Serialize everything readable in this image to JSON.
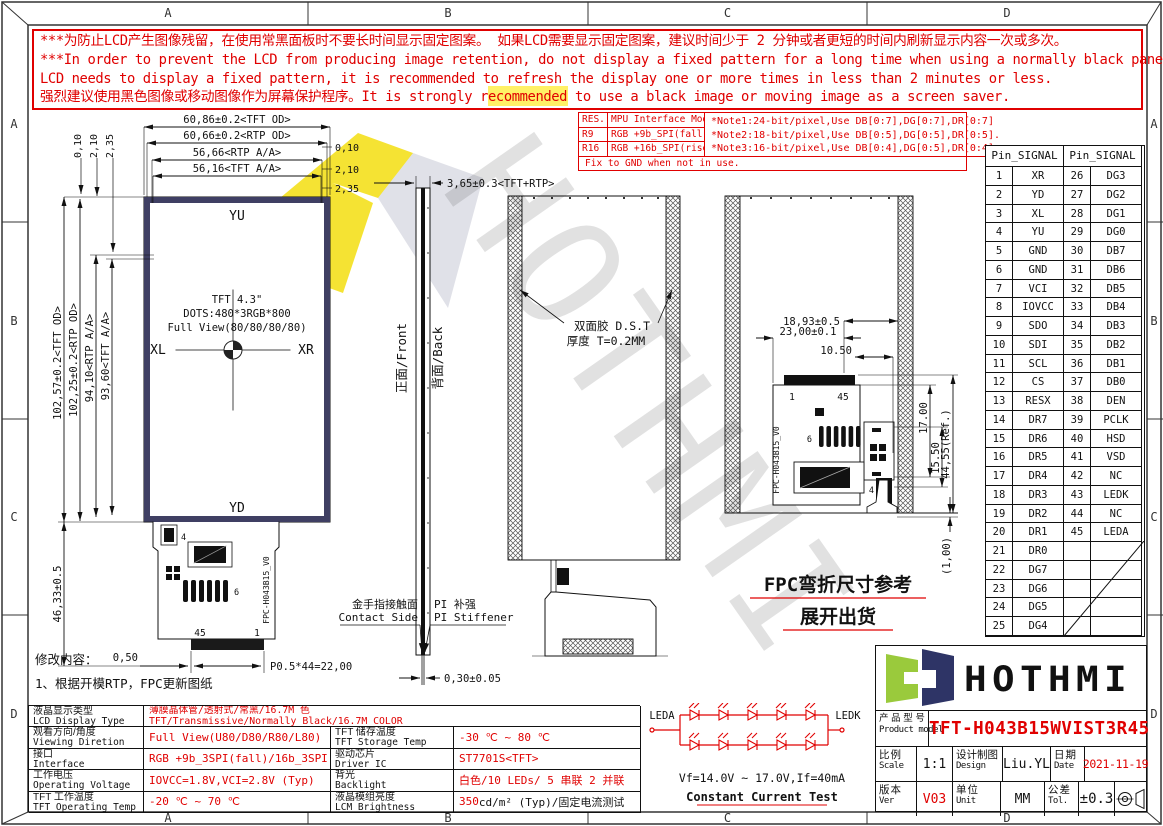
{
  "grid": {
    "cols": [
      "A",
      "B",
      "C",
      "D"
    ],
    "rows": [
      "A",
      "B",
      "C",
      "D"
    ]
  },
  "warning": {
    "lines": [
      "***为防止LCD产生图像残留，在使用常黑面板时不要长时间显示固定图案。 如果LCD需要显示固定图案，建议时间少于 2 分钟或者更短的时间内刷新显示内容一次或多次。",
      "***In order to prevent the LCD from producing image retention, do not display a fixed pattern for a long time when using a normally black panel. If the",
      " LCD needs to display a fixed pattern, it is recommended to refresh the display one or more times in less than 2 minutes or less.",
      "强烈建议使用黑色图像或移动图像作为屏幕保护程序。It is strongly recommended to use a black image or moving image as a screen saver."
    ]
  },
  "mode_table": {
    "rows": [
      [
        "RES.",
        "MPU Interface Mode"
      ],
      [
        "R9",
        "RGB +9b_SPI(fall)"
      ],
      [
        "R16",
        "RGB +16b_SPI(rise)"
      ]
    ],
    "footer": "Fix to GND  when not in use.",
    "notes": [
      "*Note1:24-bit/pixel,Use DB[0:7],DG[0:7],DR[0:7]",
      "*Note2:18-bit/pixel,Use DB[0:5],DG[0:5],DR[0:5].",
      "*Note3:16-bit/pixel,Use DB[0:4],DG[0:5],DR[0:4]."
    ]
  },
  "pin_table": {
    "header_left": "Pin_SIGNAL",
    "header_right": "Pin_SIGNAL",
    "left": [
      [
        "1",
        "XR"
      ],
      [
        "2",
        "YD"
      ],
      [
        "3",
        "XL"
      ],
      [
        "4",
        "YU"
      ],
      [
        "5",
        "GND"
      ],
      [
        "6",
        "GND"
      ],
      [
        "7",
        "VCI"
      ],
      [
        "8",
        "IOVCC"
      ],
      [
        "9",
        "SDO"
      ],
      [
        "10",
        "SDI"
      ],
      [
        "11",
        "SCL"
      ],
      [
        "12",
        "CS"
      ],
      [
        "13",
        "RESX"
      ],
      [
        "14",
        "DR7"
      ],
      [
        "15",
        "DR6"
      ],
      [
        "16",
        "DR5"
      ],
      [
        "17",
        "DR4"
      ],
      [
        "18",
        "DR3"
      ],
      [
        "19",
        "DR2"
      ],
      [
        "20",
        "DR1"
      ],
      [
        "21",
        "DR0"
      ],
      [
        "22",
        "DG7"
      ],
      [
        "23",
        "DG6"
      ],
      [
        "24",
        "DG5"
      ],
      [
        "25",
        "DG4"
      ]
    ],
    "right": [
      [
        "26",
        "DG3"
      ],
      [
        "27",
        "DG2"
      ],
      [
        "28",
        "DG1"
      ],
      [
        "29",
        "DG0"
      ],
      [
        "30",
        "DB7"
      ],
      [
        "31",
        "DB6"
      ],
      [
        "32",
        "DB5"
      ],
      [
        "33",
        "DB4"
      ],
      [
        "34",
        "DB3"
      ],
      [
        "35",
        "DB2"
      ],
      [
        "36",
        "DB1"
      ],
      [
        "37",
        "DB0"
      ],
      [
        "38",
        "DEN"
      ],
      [
        "39",
        "PCLK"
      ],
      [
        "40",
        "HSD"
      ],
      [
        "41",
        "VSD"
      ],
      [
        "42",
        "NC"
      ],
      [
        "43",
        "LEDK"
      ],
      [
        "44",
        "NC"
      ],
      [
        "45",
        "LEDA"
      ],
      [
        "",
        ""
      ],
      [
        "",
        ""
      ],
      [
        "",
        ""
      ],
      [
        "",
        ""
      ],
      [
        "",
        ""
      ]
    ]
  },
  "drawing": {
    "watermark": "HOTHMI",
    "front": {
      "top_dims": [
        "60,86±0.2<TFT OD>",
        "60,66±0.2<RTP OD>",
        "56,66<RTP A/A>",
        "56,16<TFT A/A>"
      ],
      "offsets": [
        "0,10",
        "2,10",
        "2,35"
      ],
      "left_dims": [
        "102,57±0.2<TFT OD>",
        "102,25±0.2<RTP OD>",
        "94,10<RTP A/A>",
        "93,60<TFT A/A>"
      ],
      "bottom_left_dim": "46,33±0.5",
      "yu": "YU",
      "yd": "YD",
      "xl": "XL",
      "xr": "XR",
      "center": [
        "TFT 4.3\"",
        "DOTS:480*3RGB*800",
        "Full View(80/80/80/80)"
      ],
      "pin45": "45",
      "pin1": "1",
      "comp4": "4",
      "comp6": "6",
      "fpc_name": "FPC-H043B15_V0",
      "dim_050": "0,50",
      "dim_pitch": "P0.5*44=22,00"
    },
    "side": {
      "thickness": "3,65±0.3<TFT+RTP>",
      "front_label": "正面/Front",
      "back_label": "背面/Back",
      "tail_dim": "0,30±0.05",
      "contact_cn": "金手指接触面",
      "contact_en": "Contact Side",
      "stiff_cn": "PI 补强",
      "stiff_en": "PI Stiffener"
    },
    "mid": {
      "dst1": "双面胶 D.S.T",
      "dst2": "厚度 T=0.2MM"
    },
    "right": {
      "d1": "18,93±0.5",
      "d2": "23,00±0.1",
      "d3": "10.50",
      "d4": "17.00",
      "d5": "15.50",
      "d6": "44,55(Ref.)",
      "d7": "(1,00)",
      "pin1": "1",
      "pin45": "45",
      "comp4": "4",
      "comp6": "6",
      "fpc_name": "FPC-H043B15_V0",
      "note1": "FPC弯折尺寸参考",
      "note2": "展开出货"
    },
    "revision": {
      "title": "修改内容：",
      "item": "1、根据开模RTP，FPC更新图纸"
    }
  },
  "led": {
    "a": "LEDA",
    "k": "LEDK",
    "vf": "Vf=14.0V ~ 17.0V,If=40mA",
    "test": "Constant Current Test"
  },
  "spec": {
    "r1": {
      "cn": "液晶显示类型",
      "en": "LCD Display Type",
      "v1": "薄膜晶体管/透射式/常黑/16.7M 色",
      "v2": "TFT/Transmissive/Normally Black/16.7M COLOR"
    },
    "r2": {
      "cn": "观看方向/角度",
      "en": "Viewing Diretion",
      "val": "Full View(U80/D80/R80/L80)",
      "cn2": "TFT 储存温度",
      "en2": "TFT Storage Temp",
      "val2": "-30 ℃ ~ 80 ℃"
    },
    "r3": {
      "cn": "接口",
      "en": "Interface",
      "val": "RGB +9b_3SPI(fall)/16b_3SPI(rise)",
      "cn2": "驱动芯片",
      "en2": "Driver IC",
      "val2": "ST7701S<TFT>"
    },
    "r4": {
      "cn": "工作电压",
      "en": "Operating Voltage",
      "val": "IOVCC=1.8V,VCI=2.8V (Typ)",
      "cn2": "背光",
      "en2": "Backlight",
      "val2": "白色/10 LEDs/ 5 串联 2 并联"
    },
    "r5": {
      "cn": "TFT 工作温度",
      "en": "TFT Operating Temp",
      "val": "-20 ℃ ~ 70 ℃",
      "cn2": "液晶模组亮度",
      "en2": "LCM Brightness",
      "val2_red": "350",
      "val2_rest": " cd/m² (Typ)/固定电流测试"
    }
  },
  "title_block": {
    "brand": "HOTHMI",
    "model_cn": "产 品 型 号",
    "model_en": "Product model",
    "model": "TFT-H043B15WVIST3R45",
    "scale_cn": "比例",
    "scale_en": "Scale",
    "scale": "1:1",
    "design_cn": "设计制图",
    "design_en": "Design",
    "designer": "Liu.YL",
    "date_cn": "日期",
    "date_en": "Date",
    "date": "2021-11-19",
    "ver_cn": "版本",
    "ver_en": "Ver",
    "ver": "V03",
    "unit_cn": "单位",
    "unit_en": "Unit",
    "unit": "MM",
    "tol_cn": "公差",
    "tol_en": "Tol.",
    "tol": "±0.3"
  }
}
